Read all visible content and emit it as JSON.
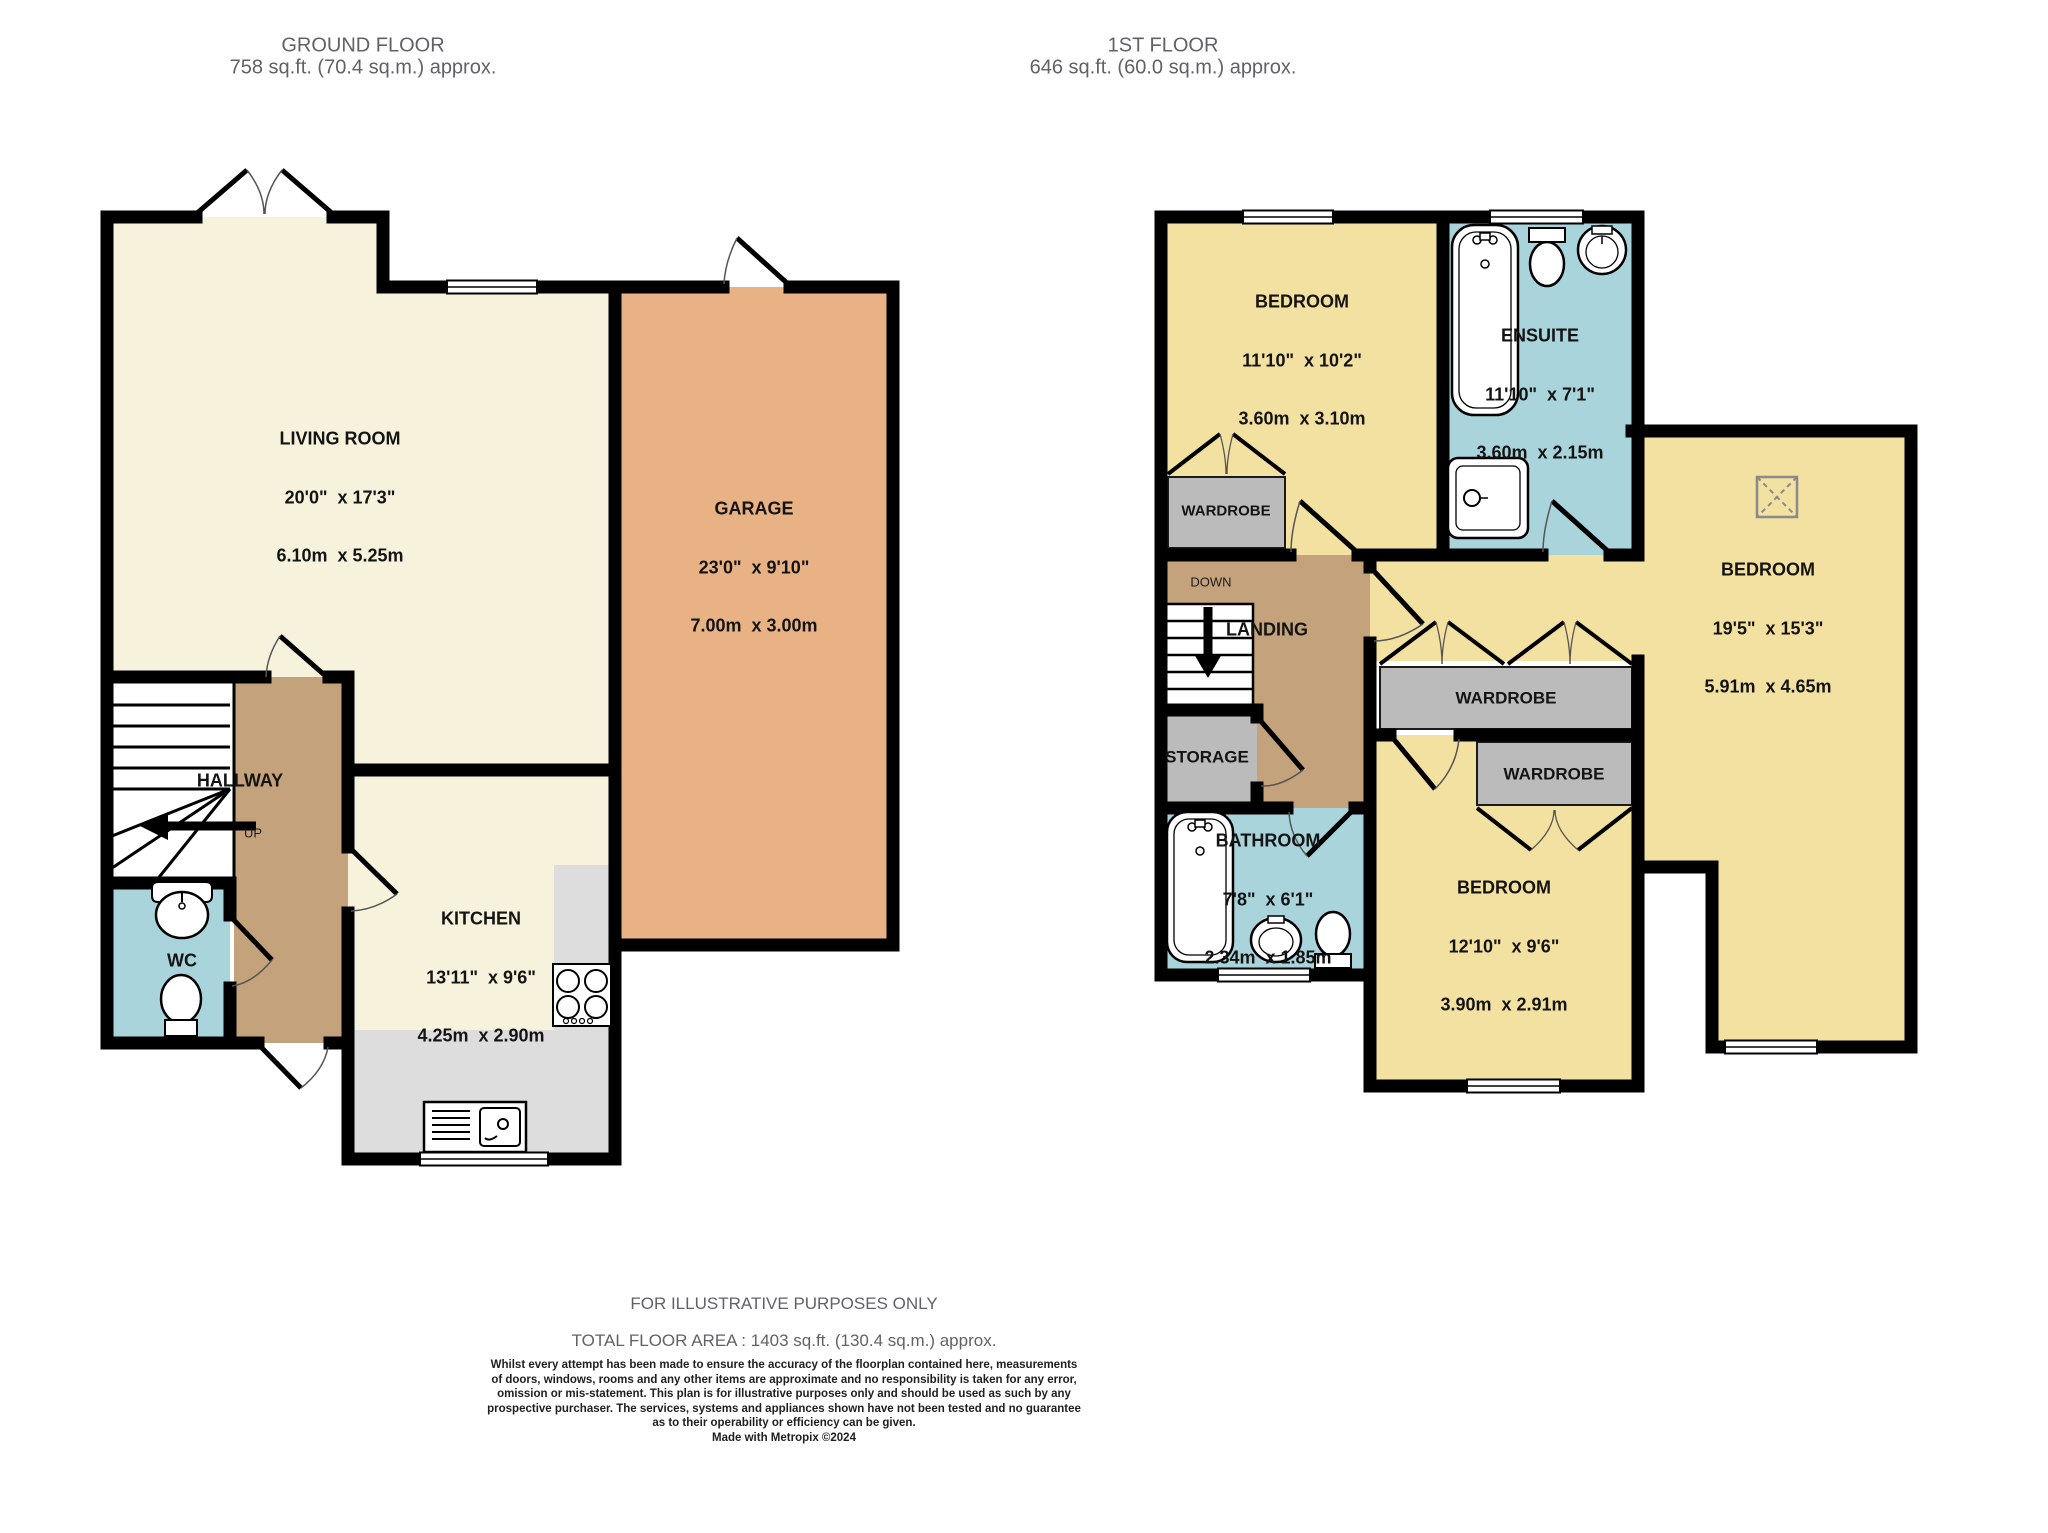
{
  "ground_floor": {
    "title": "GROUND FLOOR",
    "subtitle": "758 sq.ft. (70.4 sq.m.) approx.",
    "rooms": {
      "living": {
        "name": "LIVING ROOM",
        "imperial": "20'0\"  x 17'3\"",
        "metric": "6.10m  x 5.25m"
      },
      "garage": {
        "name": "GARAGE",
        "imperial": "23'0\"  x 9'10\"",
        "metric": "7.00m  x 3.00m"
      },
      "kitchen": {
        "name": "KITCHEN",
        "imperial": "13'11\"  x 9'6\"",
        "metric": "4.25m  x 2.90m"
      },
      "hallway": {
        "name": "HALLWAY"
      },
      "wc": {
        "name": "WC"
      },
      "up_label": "UP"
    }
  },
  "first_floor": {
    "title": "1ST FLOOR",
    "subtitle": "646 sq.ft. (60.0 sq.m.) approx.",
    "rooms": {
      "bedroom1": {
        "name": "BEDROOM",
        "imperial": "11'10\"  x 10'2\"",
        "metric": "3.60m  x 3.10m"
      },
      "ensuite": {
        "name": "ENSUITE",
        "imperial": "11'10\"  x 7'1\"",
        "metric": "3.60m  x 2.15m"
      },
      "bedroom2": {
        "name": "BEDROOM",
        "imperial": "19'5\"  x 15'3\"",
        "metric": "5.91m  x 4.65m"
      },
      "bedroom3": {
        "name": "BEDROOM",
        "imperial": "12'10\"  x 9'6\"",
        "metric": "3.90m  x 2.91m"
      },
      "bathroom": {
        "name": "BATHROOM",
        "imperial": "7'8\"  x 6'1\"",
        "metric": "2.34m  x 1.85m"
      },
      "landing": {
        "name": "LANDING"
      },
      "storage": {
        "name": "STORAGE"
      },
      "wardrobe_label": "WARDROBE",
      "down_label": "DOWN"
    }
  },
  "footer": {
    "purpose": "FOR ILLUSTRATIVE PURPOSES ONLY",
    "total_area": "TOTAL FLOOR AREA : 1403 sq.ft. (130.4 sq.m.) approx.",
    "disclaimer_lines": [
      "Whilst every attempt has been made to ensure the accuracy of the floorplan contained here, measurements",
      "of doors, windows, rooms and any other items are approximate and no responsibility is taken for any error,",
      "omission or mis-statement. This plan is for illustrative purposes only and should be used as such by any",
      "prospective purchaser. The services, systems and appliances shown have not been tested and no guarantee",
      "as to their operability or efficiency can be given."
    ],
    "credit": "Made with Metropix ©2024"
  },
  "colors": {
    "cream": "#F7F2DB",
    "garage": "#E9B285",
    "hall": "#C4A27B",
    "blue": "#A9D4DB",
    "yellow": "#F3E1A1",
    "gray": "#BBBBBB",
    "counter": "#DDDDDE",
    "wall": "#000000"
  }
}
